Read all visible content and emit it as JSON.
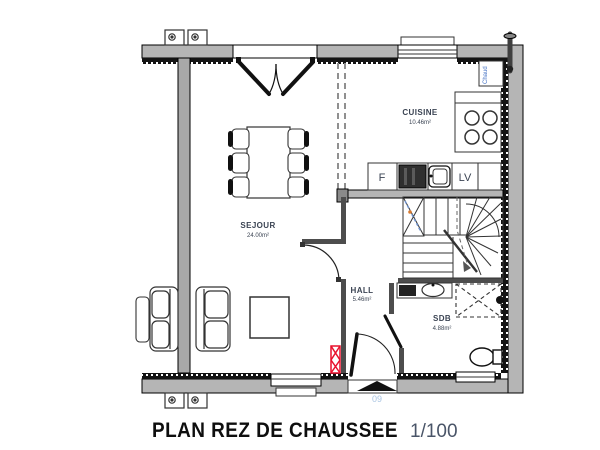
{
  "title": {
    "main": "PLAN REZ DE CHAUSSEE",
    "scale": "1/100"
  },
  "rooms": [
    {
      "id": "sejour",
      "name": "SEJOUR",
      "area": "24.00m²"
    },
    {
      "id": "cuisine",
      "name": "CUISINE",
      "area": "10.46m²"
    },
    {
      "id": "hall",
      "name": "HALL",
      "area": "5.46m²"
    },
    {
      "id": "sdb",
      "name": "SDB",
      "area": "4.88m²"
    }
  ],
  "labels": {
    "fridge": "F",
    "dishwasher": "LV",
    "boiler": "Chaud",
    "door_number": "09"
  },
  "icons": [
    "entrance-arrow-icon",
    "stairs-icon",
    "shower-icon",
    "toilet-icon",
    "washbasin-icon",
    "stove-icon",
    "sink-icon",
    "fridge-icon",
    "dishwasher-icon",
    "boiler-flue-icon",
    "sofa-icon",
    "dining-table-icon",
    "coffee-table-icon",
    "radiator-icon",
    "vent-icon",
    "french-door-icon",
    "window-icon",
    "door-swing-icon"
  ],
  "colors": {
    "wall_gray": "#b5b5b5",
    "party_wall_gray": "#a8a8a8",
    "label_navy": "#3b4453",
    "accent_red": "#e8112d",
    "boiler_blue": "#4472c4",
    "door_number_blue": "#a9c4e2"
  }
}
